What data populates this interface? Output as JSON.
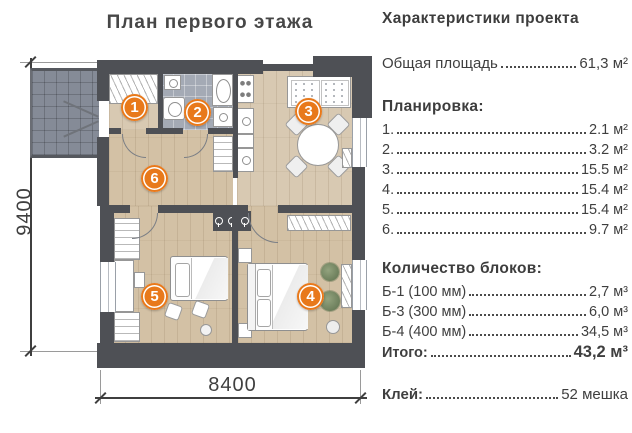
{
  "title": "План первого этажа",
  "plan": {
    "room_numbers": [
      "1",
      "2",
      "3",
      "4",
      "5",
      "6"
    ],
    "dim_height_label": "9400",
    "dim_width_label": "8400"
  },
  "panel": {
    "heading": "Характеристики проекта",
    "total_area": {
      "label": "Общая площадь",
      "value": "61,3 м²"
    },
    "layout_heading": "Планировка:",
    "layout_rows": [
      {
        "label": "1.",
        "value": "2.1 м²"
      },
      {
        "label": "2.",
        "value": "3.2 м²"
      },
      {
        "label": "3.",
        "value": "15.5 м²"
      },
      {
        "label": "4.",
        "value": "15.4 м²"
      },
      {
        "label": "5.",
        "value": "15.4 м²"
      },
      {
        "label": "6.",
        "value": "9.7 м²"
      }
    ],
    "blocks_heading": "Количество блоков:",
    "block_rows": [
      {
        "label": "Б-1 (100 мм)",
        "value": "2,7 м³"
      },
      {
        "label": "Б-3 (300 мм)",
        "value": "6,0 м³"
      },
      {
        "label": "Б-4 (400 мм)",
        "value": "34,5 м³"
      }
    ],
    "total_row": {
      "label": "Итого:",
      "value": "43,2 м³"
    },
    "glue_row": {
      "label": "Клей:",
      "value": "52 мешка"
    }
  },
  "colors": {
    "accent_orange": "#E8791B",
    "wall_gray": "#4E5055",
    "wood_floor": "#D8C9B2",
    "bath_tile": "#A4AAB5",
    "porch_tile": "#858B97",
    "text_dark": "#3F3F3F"
  }
}
